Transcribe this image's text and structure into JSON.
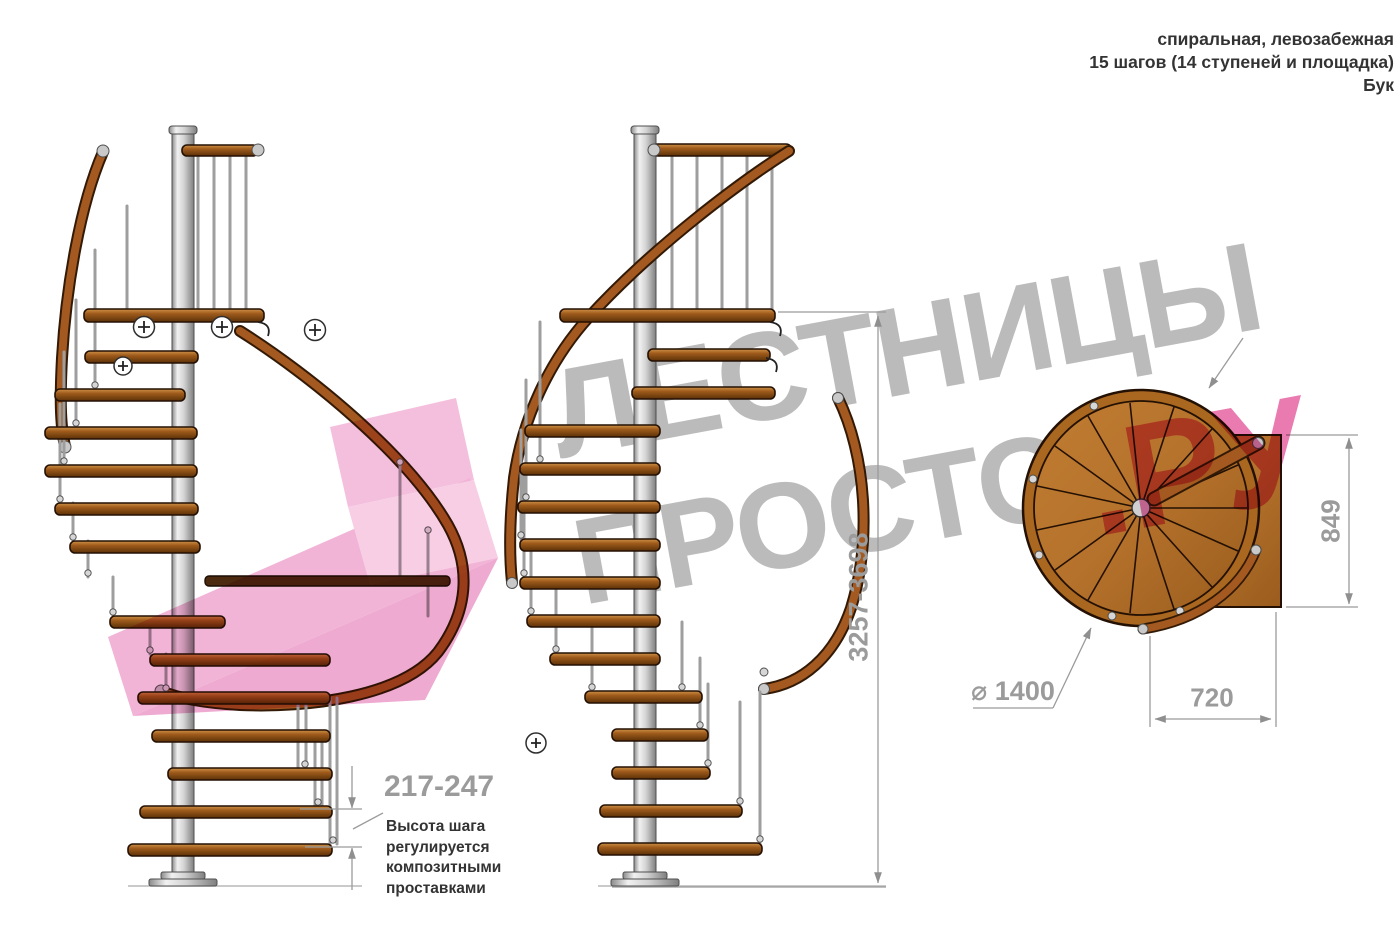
{
  "header": {
    "line1": "спиральная, левозабежная",
    "line2": "15 шагов (14 ступеней и площадка)",
    "line3": "Бук"
  },
  "watermark": {
    "line1": "ЛЕСТНИЦЫ",
    "line2_gray": "ПРОСТО",
    "line2_pink": ".РУ",
    "gray_color": "#7d7d7d",
    "pink_color": "#e55a9c"
  },
  "dimensions": {
    "step_height": {
      "value": "217-247",
      "note_lines": [
        "Высота шага",
        "регулируется",
        "композитными",
        "проставками"
      ]
    },
    "total_height": {
      "value": "3257-3698"
    },
    "plan_depth": {
      "value": "849"
    },
    "plan_width": {
      "value": "720"
    },
    "plan_diameter": {
      "symbol": "⌀",
      "value": "1400"
    }
  },
  "colors": {
    "wood": "#a05c1c",
    "handrail": "#a3591f",
    "metal": "#d2d2d2",
    "dimension": "#9b9b9b"
  }
}
